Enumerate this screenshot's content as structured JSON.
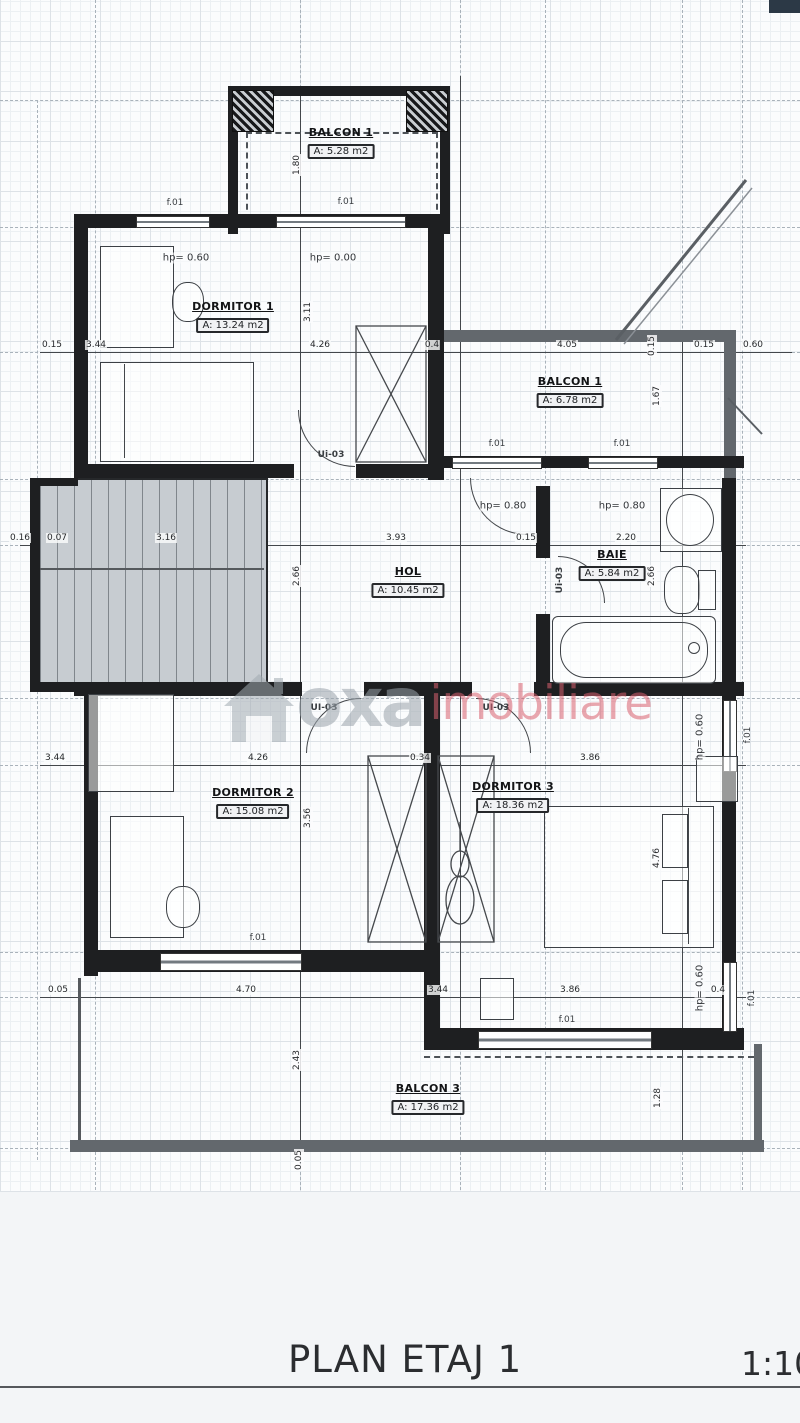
{
  "title": "PLAN ETAJ 1",
  "scale": "1:10",
  "watermark": {
    "part1": "oxa",
    "part2": "imobiliare"
  },
  "rooms": {
    "balcon1_top": {
      "name": "BALCON 1",
      "area": "A: 5.28 m2"
    },
    "dormitor1": {
      "name": "DORMITOR 1",
      "area": "A: 13.24 m2"
    },
    "balcon1_right": {
      "name": "BALCON 1",
      "area": "A: 6.78 m2"
    },
    "hol": {
      "name": "HOL",
      "area": "A: 10.45 m2"
    },
    "baie": {
      "name": "BAIE",
      "area": "A: 5.84 m2"
    },
    "dormitor2": {
      "name": "DORMITOR 2",
      "area": "A: 15.08 m2"
    },
    "dormitor3": {
      "name": "DORMITOR 3",
      "area": "A: 18.36 m2"
    },
    "balcon3": {
      "name": "BALCON 3",
      "area": "A: 17.36 m2"
    }
  },
  "levels": {
    "hp060": "hp= 0.60",
    "hp000": "hp= 0.00",
    "hp080": "hp= 0.80"
  },
  "doors": {
    "mixed": "Ui-03",
    "upper": "UI-03"
  },
  "windows": {
    "f01": "f.01"
  },
  "dims": {
    "row1": [
      "0.15",
      "3.44",
      "4.26",
      "0.4",
      "4.05",
      "0.15",
      "0.60"
    ],
    "row2": [
      "0.16",
      "0.07",
      "3.16",
      "3.93",
      "0.15",
      "2.20"
    ],
    "row3": [
      "3.44",
      "4.26",
      "0.34",
      "3.86"
    ],
    "row4": [
      "0.05",
      "4.70",
      "3.44",
      "3.86",
      "0.4"
    ],
    "vert": [
      "1.80",
      "3.11",
      "1.67",
      "2.66",
      "2.66",
      "3.56",
      "4.76",
      "2.43",
      "1.28",
      "0.05",
      "0.15"
    ]
  }
}
